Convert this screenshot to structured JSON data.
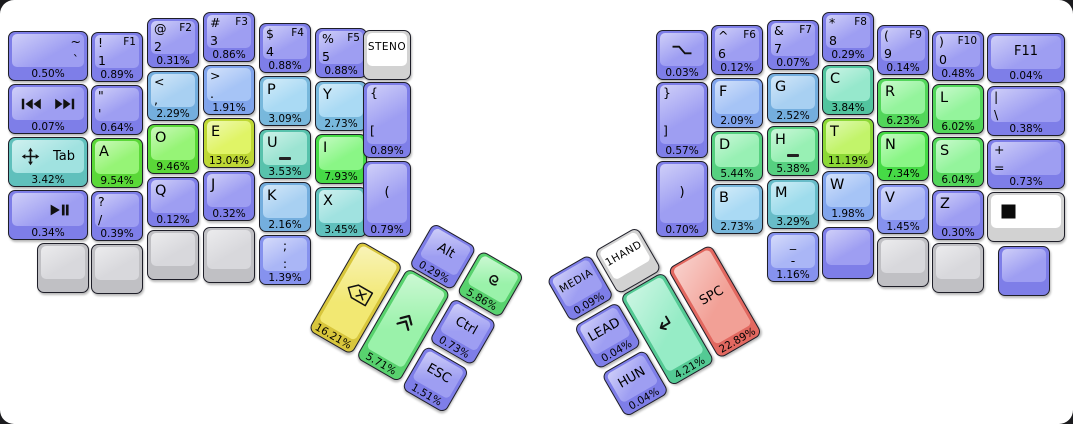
{
  "canvas": {
    "background": "#ffffff",
    "frame_background": "#1b1b1e"
  },
  "palette": {
    "b": [
      "#7e7ee8",
      "#9e9ef2"
    ],
    "b1": [
      "#8692ee",
      "#aab6f6"
    ],
    "b2": [
      "#80a4ec",
      "#a6c4f6"
    ],
    "lb": [
      "#74aede",
      "#a8d0f2"
    ],
    "lb2": [
      "#78b8dc",
      "#aadaf4"
    ],
    "cy": [
      "#68bcc8",
      "#9edcec"
    ],
    "cy2": [
      "#60c0bc",
      "#a0e2e0"
    ],
    "te": [
      "#58c2ac",
      "#9ce4d2"
    ],
    "te2": [
      "#52c49e",
      "#96e8cc"
    ],
    "mint": [
      "#54ca94",
      "#96ecc6"
    ],
    "mg": [
      "#56d080",
      "#98f0b4"
    ],
    "g1": [
      "#58d26e",
      "#9af2aa"
    ],
    "g2": [
      "#52d65a",
      "#94f49c"
    ],
    "g3": [
      "#46da46",
      "#8af686"
    ],
    "g4": [
      "#5ad838",
      "#96f476"
    ],
    "yg": [
      "#8cd836",
      "#c2f46a"
    ],
    "y1": [
      "#bed834",
      "#e0f466"
    ],
    "ye": [
      "#d8c63c",
      "#f2e872"
    ],
    "rd": [
      "#e26860",
      "#f2a096"
    ],
    "gr": [
      "#c0c0c4",
      "#d8d8dc"
    ],
    "wh": [
      "#d2d2d2",
      "#ffffff"
    ]
  },
  "keyboard": {
    "main": [
      {
        "name": "key-grave-tilde",
        "x": 8,
        "y": 31,
        "w": 80,
        "c": "b",
        "tr2": "~",
        "mr": "`",
        "pct": "0.50%"
      },
      {
        "name": "key-media-prev-next",
        "x": 8,
        "y": 84,
        "w": 80,
        "c": "b",
        "icons": [
          "skip-previous",
          "skip-next"
        ],
        "iconAlign": "spread",
        "pct": "0.07%"
      },
      {
        "name": "key-tab-move",
        "x": 8,
        "y": 137,
        "w": 80,
        "c": "cy2",
        "icons": [
          "move"
        ],
        "iconAlign": "spread",
        "labelRight": "Tab",
        "pct": "3.42%"
      },
      {
        "name": "key-play-pause",
        "x": 8,
        "y": 190,
        "w": 80,
        "c": "b",
        "icons": [
          "play-pause"
        ],
        "iconAlign": "right",
        "pct": "0.34%"
      },
      {
        "name": "key-blank-l1",
        "x": 37,
        "y": 243,
        "c": "gr"
      },
      {
        "name": "key-1",
        "x": 91,
        "y": 32,
        "c": "b",
        "tl": "!",
        "tr": "F1",
        "ml": "1",
        "pct": "0.89%"
      },
      {
        "name": "key-quote",
        "x": 91,
        "y": 85,
        "c": "b",
        "tl": "\"",
        "ml": "'",
        "pct": "0.64%"
      },
      {
        "name": "key-a",
        "x": 91,
        "y": 138,
        "c": "g4",
        "l": "A",
        "pct": "9.54%"
      },
      {
        "name": "key-slash",
        "x": 91,
        "y": 191,
        "c": "b",
        "tl": "?",
        "ml": "/",
        "pct": "0.39%"
      },
      {
        "name": "key-blank-l2",
        "x": 91,
        "y": 244,
        "c": "gr"
      },
      {
        "name": "key-2",
        "x": 147,
        "y": 18,
        "c": "b",
        "tl": "@",
        "tr": "F2",
        "ml": "2",
        "pct": "0.31%"
      },
      {
        "name": "key-comma",
        "x": 147,
        "y": 71,
        "c": "lb",
        "tl": "<",
        "ml": ",",
        "pct": "2.29%"
      },
      {
        "name": "key-o",
        "x": 147,
        "y": 124,
        "c": "g4",
        "l": "O",
        "pct": "9.46%"
      },
      {
        "name": "key-q",
        "x": 147,
        "y": 177,
        "c": "b",
        "l": "Q",
        "pct": "0.12%"
      },
      {
        "name": "key-blank-l3",
        "x": 147,
        "y": 230,
        "c": "gr"
      },
      {
        "name": "key-3",
        "x": 203,
        "y": 12,
        "c": "b",
        "tl": "#",
        "tr": "F3",
        "ml": "3",
        "pct": "0.86%"
      },
      {
        "name": "key-period",
        "x": 203,
        "y": 65,
        "c": "b2",
        "tl": ">",
        "ml": ".",
        "pct": "1.91%"
      },
      {
        "name": "key-e",
        "x": 203,
        "y": 118,
        "c": "y1",
        "l": "E",
        "pct": "13.04%"
      },
      {
        "name": "key-j",
        "x": 203,
        "y": 171,
        "c": "b",
        "l": "J",
        "pct": "0.32%"
      },
      {
        "name": "key-blank-l4",
        "x": 203,
        "y": 227,
        "h": 56,
        "c": "gr"
      },
      {
        "name": "key-4",
        "x": 259,
        "y": 23,
        "c": "b",
        "tl": "$",
        "tr": "F4",
        "ml": "4",
        "pct": "0.88%"
      },
      {
        "name": "key-p",
        "x": 259,
        "y": 76,
        "c": "lb2",
        "l": "P",
        "pct": "3.09%"
      },
      {
        "name": "key-u",
        "x": 259,
        "y": 129,
        "c": "te",
        "l": "U",
        "homing": true,
        "pct": "3.53%"
      },
      {
        "name": "key-k",
        "x": 259,
        "y": 182,
        "c": "lb",
        "l": "K",
        "pct": "2.16%"
      },
      {
        "name": "key-semicolon",
        "x": 259,
        "y": 235,
        "c": "b1",
        "tc": ";",
        "mc": ":",
        "pct": "1.39%"
      },
      {
        "name": "key-5",
        "x": 315,
        "y": 28,
        "c": "b",
        "tl": "%",
        "tr": "F5",
        "ml": "5",
        "pct": "0.88%"
      },
      {
        "name": "key-y",
        "x": 315,
        "y": 81,
        "c": "lb2",
        "l": "Y",
        "pct": "2.73%"
      },
      {
        "name": "key-i",
        "x": 315,
        "y": 134,
        "c": "g3",
        "l": "I",
        "pct": "7.93%"
      },
      {
        "name": "key-x",
        "x": 315,
        "y": 187,
        "c": "cy2",
        "l": "X",
        "pct": "3.45%"
      },
      {
        "name": "key-steno",
        "x": 363,
        "y": 30,
        "w": 48,
        "c": "wh",
        "cc": "STENO"
      },
      {
        "name": "key-lbracket",
        "x": 363,
        "y": 82,
        "w": 48,
        "h": 76,
        "c": "b",
        "tl": "{",
        "ml2": "[",
        "pct": "0.89%"
      },
      {
        "name": "key-lparen",
        "x": 363,
        "y": 161,
        "w": 48,
        "h": 76,
        "c": "b",
        "cc": "(",
        "pct": "0.79%"
      },
      {
        "name": "key-sleep",
        "x": 656,
        "y": 30,
        "c": "b",
        "icons": [
          "sleep"
        ],
        "pct": "0.03%"
      },
      {
        "name": "key-rbracket",
        "x": 656,
        "y": 82,
        "h": 76,
        "c": "b",
        "tl": "}",
        "ml2": "]",
        "pct": "0.57%"
      },
      {
        "name": "key-rparen",
        "x": 656,
        "y": 161,
        "h": 76,
        "c": "b",
        "cc": ")",
        "pct": "0.70%"
      },
      {
        "name": "key-6",
        "x": 711,
        "y": 25,
        "c": "b",
        "tl": "^",
        "tr": "F6",
        "ml": "6",
        "pct": "0.12%"
      },
      {
        "name": "key-f",
        "x": 711,
        "y": 78,
        "c": "b2",
        "l": "F",
        "pct": "2.09%"
      },
      {
        "name": "key-d",
        "x": 711,
        "y": 131,
        "c": "mg",
        "l": "D",
        "pct": "5.44%"
      },
      {
        "name": "key-b",
        "x": 711,
        "y": 184,
        "c": "lb2",
        "l": "B",
        "pct": "2.73%"
      },
      {
        "name": "key-7",
        "x": 767,
        "y": 20,
        "c": "b",
        "tl": "&",
        "tr": "F7",
        "ml": "7",
        "pct": "0.07%"
      },
      {
        "name": "key-g",
        "x": 767,
        "y": 73,
        "c": "lb",
        "l": "G",
        "pct": "2.52%"
      },
      {
        "name": "key-h",
        "x": 767,
        "y": 126,
        "c": "mg",
        "l": "H",
        "homing": true,
        "pct": "5.38%"
      },
      {
        "name": "key-m",
        "x": 767,
        "y": 179,
        "c": "cy",
        "l": "M",
        "pct": "3.29%"
      },
      {
        "name": "key-minus",
        "x": 767,
        "y": 232,
        "c": "b1",
        "tc": "_",
        "mc": "-",
        "pct": "1.16%"
      },
      {
        "name": "key-8",
        "x": 822,
        "y": 12,
        "c": "b",
        "tl": "*",
        "tr": "F8",
        "ml": "8",
        "pct": "0.29%"
      },
      {
        "name": "key-c",
        "x": 822,
        "y": 65,
        "c": "te2",
        "l": "C",
        "pct": "3.84%"
      },
      {
        "name": "key-t",
        "x": 822,
        "y": 118,
        "c": "yg",
        "l": "T",
        "pct": "11.19%"
      },
      {
        "name": "key-w",
        "x": 822,
        "y": 171,
        "c": "b2",
        "l": "W",
        "pct": "1.98%"
      },
      {
        "name": "key-blank-r1",
        "x": 822,
        "y": 227,
        "h": 52,
        "c": "b"
      },
      {
        "name": "key-9",
        "x": 877,
        "y": 25,
        "c": "b",
        "tl": "(",
        "tr": "F9",
        "ml": "9",
        "pct": "0.14%"
      },
      {
        "name": "key-r",
        "x": 877,
        "y": 78,
        "c": "g2",
        "l": "R",
        "pct": "6.23%"
      },
      {
        "name": "key-n",
        "x": 877,
        "y": 131,
        "c": "g3",
        "l": "N",
        "pct": "7.34%"
      },
      {
        "name": "key-v",
        "x": 877,
        "y": 184,
        "c": "b1",
        "l": "V",
        "pct": "1.45%"
      },
      {
        "name": "key-blank-r2",
        "x": 877,
        "y": 237,
        "c": "gr"
      },
      {
        "name": "key-0",
        "x": 932,
        "y": 31,
        "c": "b",
        "tl": ")",
        "tr": "F10",
        "ml": "0",
        "pct": "0.48%"
      },
      {
        "name": "key-l",
        "x": 932,
        "y": 84,
        "c": "g2",
        "l": "L",
        "pct": "6.02%"
      },
      {
        "name": "key-s",
        "x": 932,
        "y": 137,
        "c": "g2",
        "l": "S",
        "pct": "6.04%"
      },
      {
        "name": "key-z",
        "x": 932,
        "y": 190,
        "c": "b",
        "l": "Z",
        "pct": "0.30%"
      },
      {
        "name": "key-blank-r3",
        "x": 932,
        "y": 243,
        "c": "gr"
      },
      {
        "name": "key-f11",
        "x": 987,
        "y": 33,
        "w": 78,
        "c": "b",
        "cc": "F11",
        "pct": "0.04%"
      },
      {
        "name": "key-backslash",
        "x": 987,
        "y": 86,
        "w": 78,
        "c": "b",
        "tl": "|",
        "ml": "\\",
        "pct": "0.38%"
      },
      {
        "name": "key-equals",
        "x": 987,
        "y": 139,
        "w": 78,
        "c": "b",
        "tl": "+",
        "ml": "=",
        "pct": "0.73%"
      },
      {
        "name": "key-stop",
        "x": 987,
        "y": 192,
        "w": 78,
        "c": "wh",
        "icons": [
          "stop-square"
        ],
        "iconAlign": "left"
      },
      {
        "name": "key-blank-r4",
        "x": 998,
        "y": 246,
        "c": "b"
      }
    ],
    "clusters": [
      {
        "name": "left-thumb-cluster",
        "x": 386,
        "y": 195,
        "angle": 30,
        "keys": [
          {
            "name": "key-backspace",
            "x": 0,
            "y": 52,
            "w": 50,
            "h": 104,
            "c": "ye",
            "icons": [
              "backspace"
            ],
            "pct": "16.21%"
          },
          {
            "name": "key-alt",
            "x": 55,
            "y": 0,
            "w": 50,
            "c": "b",
            "cc": "Alt",
            "pct": "0.29%"
          },
          {
            "name": "key-shift",
            "x": 55,
            "y": 52,
            "w": 50,
            "h": 104,
            "c": "g1",
            "icons": [
              "shift"
            ],
            "pct": "5.71%"
          },
          {
            "name": "key-super",
            "x": 110,
            "y": 0,
            "w": 50,
            "c": "g1",
            "icons": [
              "debian-swirl"
            ],
            "pct": "5.86%"
          },
          {
            "name": "key-ctrl",
            "x": 110,
            "y": 55,
            "w": 50,
            "c": "b",
            "cc": "Ctrl",
            "pct": "0.73%"
          },
          {
            "name": "key-esc",
            "x": 110,
            "y": 110,
            "w": 50,
            "c": "b",
            "cc": "ESC",
            "pct": "1.51%"
          }
        ]
      },
      {
        "name": "right-thumb-cluster",
        "x": 546,
        "y": 279,
        "angle": -30,
        "keys": [
          {
            "name": "key-media",
            "x": 0,
            "y": 0,
            "w": 50,
            "c": "b",
            "cc": "MEDIA",
            "pct": "0.09%"
          },
          {
            "name": "key-lead",
            "x": 0,
            "y": 55,
            "w": 50,
            "c": "b",
            "cc": "LEAD",
            "pct": "0.04%"
          },
          {
            "name": "key-hun",
            "x": 0,
            "y": 110,
            "w": 50,
            "c": "b",
            "cc": "HUN",
            "pct": "0.04%"
          },
          {
            "name": "key-1hand",
            "x": 55,
            "y": 0,
            "w": 50,
            "c": "wh",
            "cc": "1HAND"
          },
          {
            "name": "key-enter",
            "x": 55,
            "y": 52,
            "w": 50,
            "h": 104,
            "c": "mint",
            "icons": [
              "enter"
            ],
            "pct": "4.21%"
          },
          {
            "name": "key-spc",
            "x": 110,
            "y": 52,
            "w": 50,
            "h": 104,
            "c": "rd",
            "cc": "SPC",
            "pct": "22.89%"
          }
        ]
      }
    ]
  }
}
